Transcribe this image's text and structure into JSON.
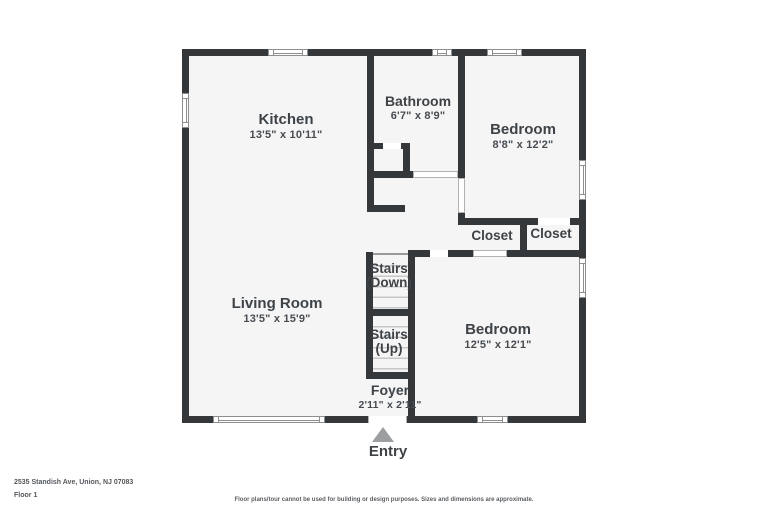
{
  "floorplan": {
    "rooms": {
      "kitchen": {
        "name": "Kitchen",
        "dims": "13'5\" x 10'11\""
      },
      "bathroom": {
        "name": "Bathroom",
        "dims": "6'7\" x 8'9\""
      },
      "bedroom1": {
        "name": "Bedroom",
        "dims": "8'8\" x 12'2\""
      },
      "closet_left": {
        "name": "Closet"
      },
      "closet_right": {
        "name": "Closet"
      },
      "stairs_down": {
        "name": "Stairs",
        "sub": "(Down)"
      },
      "stairs_up": {
        "name": "Stairs",
        "sub": "(Up)"
      },
      "living_room": {
        "name": "Living Room",
        "dims": "13'5\" x 15'9\""
      },
      "bedroom2": {
        "name": "Bedroom",
        "dims": "12'5\" x 12'1\""
      },
      "foyer": {
        "name": "Foyer",
        "dims": "2'11\" x 2'11\""
      }
    },
    "entry_label": "Entry"
  },
  "footer": {
    "address": "2535 Standish Ave, Union, NJ 07083",
    "floor_label": "Floor 1",
    "disclaimer": "Floor plans/tour cannot be used for building or design purposes. Sizes and dimensions are approximate."
  },
  "colors": {
    "wall": "#34383b",
    "floor": "#f5f5f6",
    "text": "#3e4347",
    "entry_arrow": "#9b9fa2"
  }
}
